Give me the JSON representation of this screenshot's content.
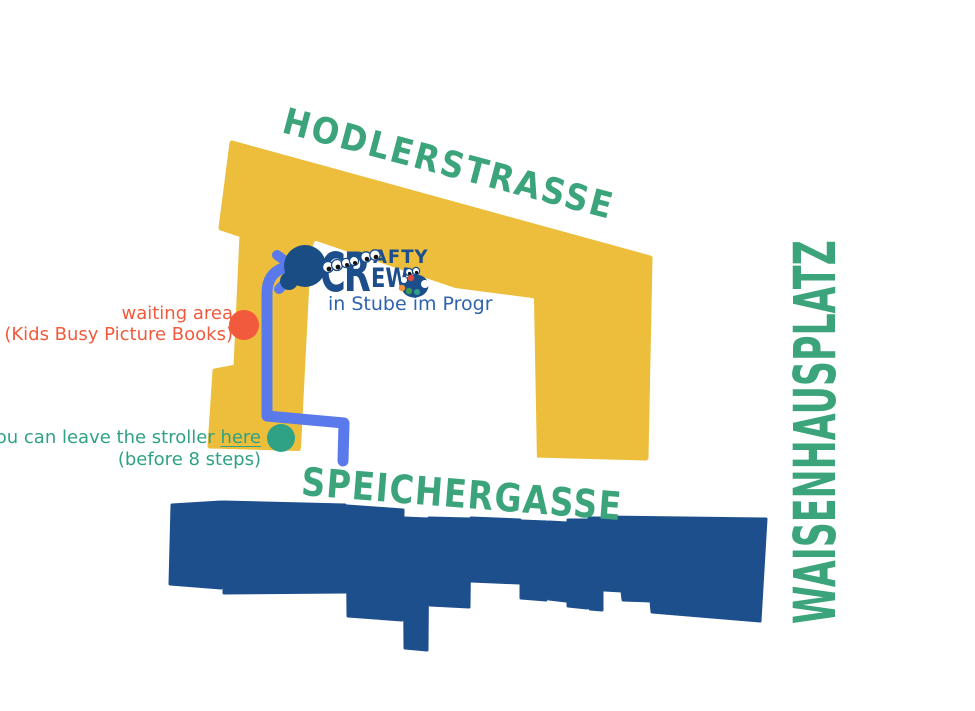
{
  "streets": {
    "top": "HODLERSTRASSE",
    "bottom": "SPEICHERGASSE",
    "right": "WAISENHAUSPLATZ"
  },
  "destination": {
    "logo_cr": "CR",
    "logo_afty": "AFTY",
    "logo_ew": "EW",
    "caption": "in Stube im Progr"
  },
  "annotations": {
    "waiting": {
      "line1": "waiting area",
      "line2": "(Kids Busy Picture Books)"
    },
    "stroller": {
      "line1_prefix": "you can leave the stroller ",
      "line1_link": "here",
      "line2": "(before 8 steps)"
    }
  },
  "icons": {
    "palette": "paint-palette-icon",
    "googly_eyes": "googly-eyes-icon",
    "destination_marker": "destination-dot",
    "route_arrow": "route-arrowhead"
  },
  "colors": {
    "progr_yellow": "#ECBE3C",
    "buildings_navy": "#1C4F8C",
    "route_blue": "#5A79EA",
    "street_green": "#3BA47B",
    "waiting_orange": "#F15A3D",
    "stroller_teal": "#2FA285",
    "logo_navy": "#1D4E8C",
    "caption_blue": "#2E63AE"
  }
}
